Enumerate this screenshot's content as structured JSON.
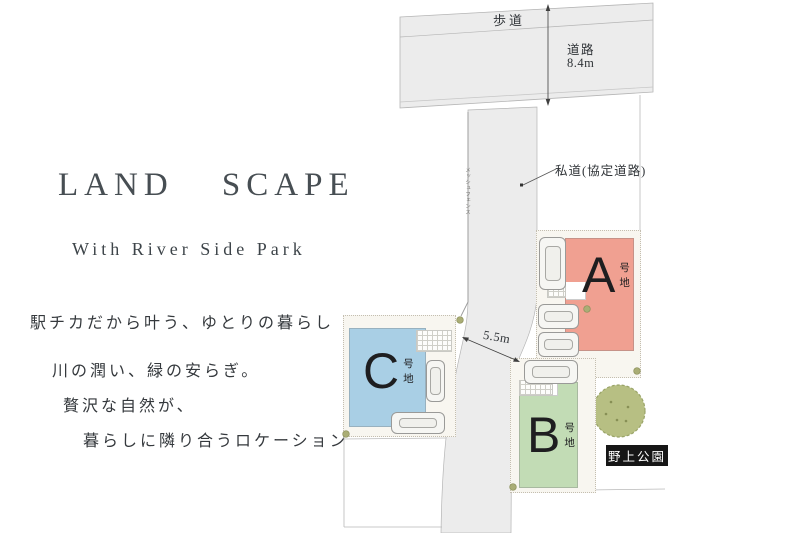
{
  "branding": {
    "title": "LAND SCAPE",
    "subtitle": "With River Side Park",
    "taglines": [
      "駅チカだから叶う、ゆとりの暮らし",
      "川の潤い、緑の安らぎ。",
      "贅沢な自然が、",
      "暮らしに隣り合うロケーション"
    ]
  },
  "map": {
    "road": {
      "sidewalk_label": "歩道",
      "name": "道路",
      "width": "8.4m"
    },
    "private_road": {
      "label": "私道(協定道路)",
      "width_label": "5.5m"
    },
    "fence_label": "メッシュフェンス",
    "park": {
      "name": "野上公園"
    },
    "plots": [
      {
        "id": "A",
        "letter": "A",
        "suffix": "号地",
        "color": "#f0a091"
      },
      {
        "id": "B",
        "letter": "B",
        "suffix": "号地",
        "color": "#c2dcb5"
      },
      {
        "id": "C",
        "letter": "C",
        "suffix": "号地",
        "color": "#a9cfe5"
      }
    ],
    "colors": {
      "road_fill": "#ececec",
      "plot_area_fill": "#f8f6f0",
      "tree": "#b7bf83",
      "park_label_bg": "#161616"
    }
  }
}
